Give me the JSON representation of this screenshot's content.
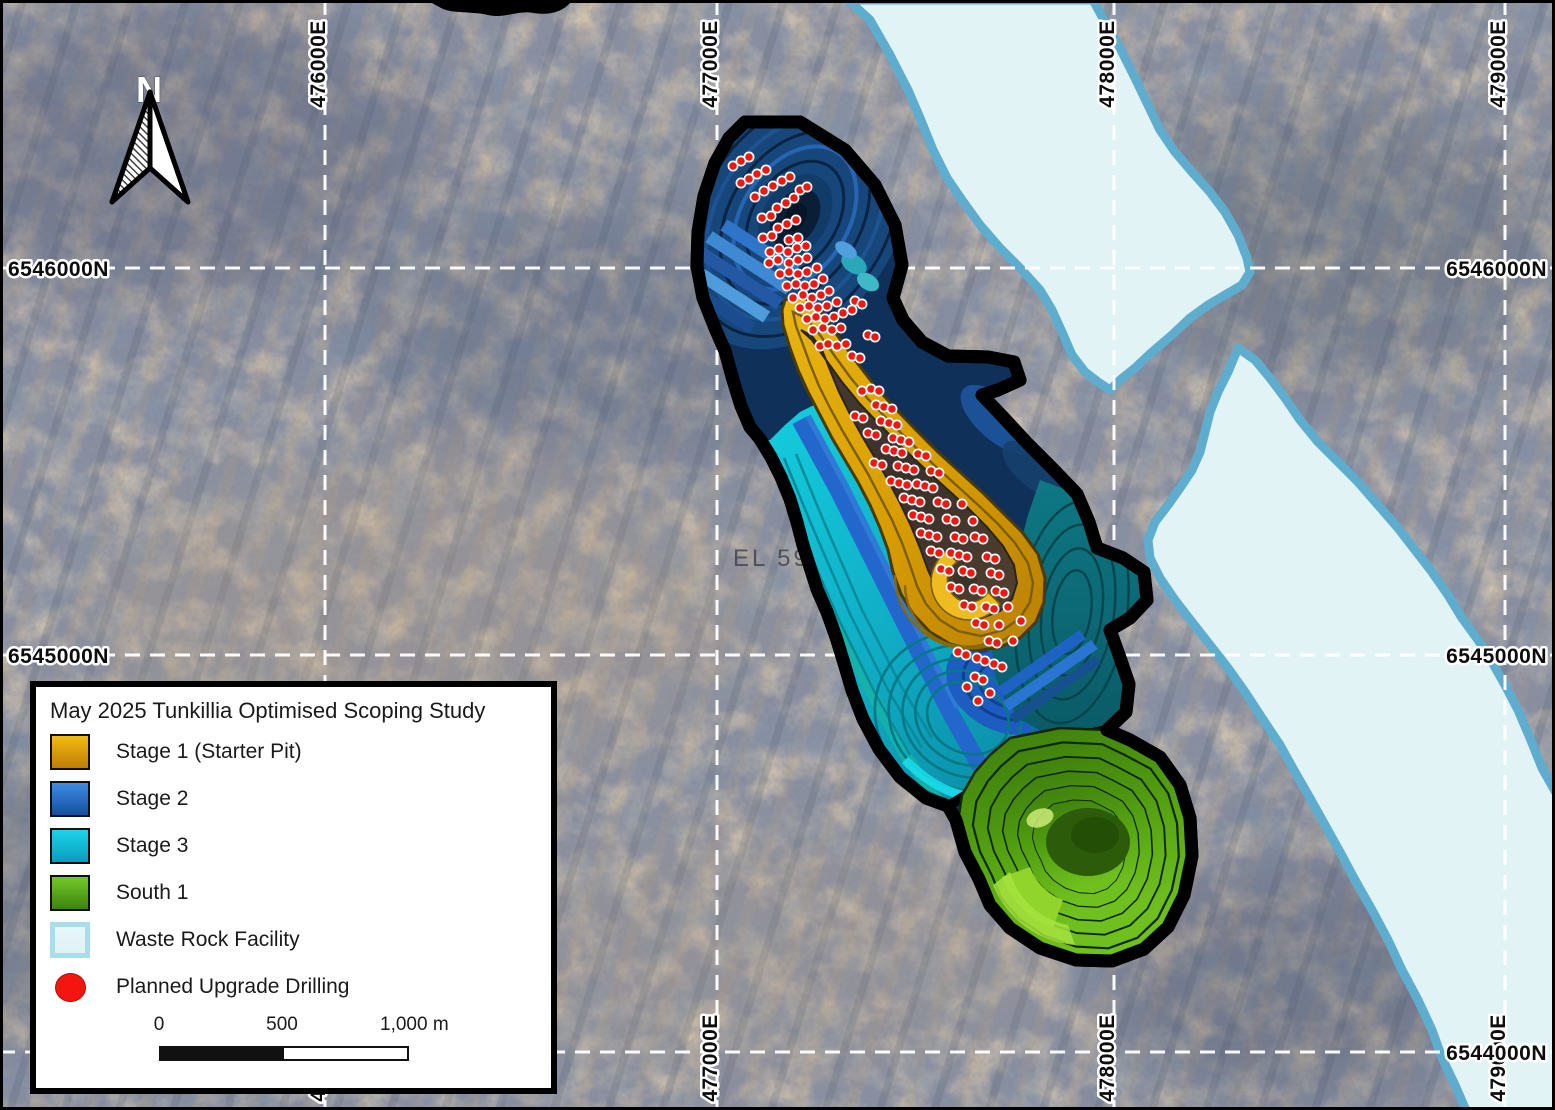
{
  "map": {
    "compass_label": "N",
    "tenement_label": "EL 590",
    "grid": {
      "eastings": [
        {
          "label": "476000E",
          "x": 325
        },
        {
          "label": "477000E",
          "x": 717
        },
        {
          "label": "478000E",
          "x": 1114
        },
        {
          "label": "479000E",
          "x": 1505
        }
      ],
      "northings": [
        {
          "label": "6546000N",
          "y": 268,
          "sides": [
            "left",
            "right"
          ]
        },
        {
          "label": "6545000N",
          "y": 655,
          "sides": [
            "left",
            "right"
          ]
        },
        {
          "label": "6544000N",
          "y": 1052,
          "sides": [
            "right"
          ]
        }
      ]
    },
    "colors": {
      "grid_line": "#ffffff",
      "pit_outline": "#000000",
      "stage1_gold": "#e0a706",
      "stage2_blue": "#1f62c4",
      "stage3_cyan": "#12c2d8",
      "south1_green": "#55a312",
      "wrf_fill": "#e2f3f5",
      "wrf_border": "#5fadce",
      "drill_red": "#ee1812"
    },
    "drill_points": [
      [
        733,
        166
      ],
      [
        741,
        161
      ],
      [
        749,
        157
      ],
      [
        741,
        183
      ],
      [
        749,
        179
      ],
      [
        757,
        174
      ],
      [
        766,
        170
      ],
      [
        755,
        197
      ],
      [
        764,
        191
      ],
      [
        773,
        186
      ],
      [
        782,
        181
      ],
      [
        790,
        177
      ],
      [
        777,
        208
      ],
      [
        786,
        203
      ],
      [
        794,
        198
      ],
      [
        762,
        218
      ],
      [
        771,
        216
      ],
      [
        800,
        190
      ],
      [
        807,
        187
      ],
      [
        778,
        228
      ],
      [
        787,
        224
      ],
      [
        796,
        220
      ],
      [
        763,
        238
      ],
      [
        772,
        236
      ],
      [
        789,
        240
      ],
      [
        798,
        238
      ],
      [
        770,
        252
      ],
      [
        779,
        249
      ],
      [
        788,
        252
      ],
      [
        797,
        248
      ],
      [
        806,
        246
      ],
      [
        769,
        263
      ],
      [
        778,
        260
      ],
      [
        789,
        263
      ],
      [
        798,
        260
      ],
      [
        807,
        258
      ],
      [
        780,
        274
      ],
      [
        789,
        272
      ],
      [
        798,
        274
      ],
      [
        807,
        272
      ],
      [
        817,
        268
      ],
      [
        787,
        286
      ],
      [
        796,
        284
      ],
      [
        805,
        286
      ],
      [
        814,
        284
      ],
      [
        823,
        279
      ],
      [
        793,
        298
      ],
      [
        803,
        295
      ],
      [
        812,
        298
      ],
      [
        821,
        295
      ],
      [
        829,
        291
      ],
      [
        800,
        308
      ],
      [
        809,
        306
      ],
      [
        818,
        308
      ],
      [
        827,
        306
      ],
      [
        837,
        302
      ],
      [
        852,
        310
      ],
      [
        807,
        319
      ],
      [
        816,
        317
      ],
      [
        825,
        319
      ],
      [
        834,
        317
      ],
      [
        843,
        313
      ],
      [
        813,
        330
      ],
      [
        823,
        328
      ],
      [
        832,
        330
      ],
      [
        841,
        328
      ],
      [
        855,
        301
      ],
      [
        862,
        304
      ],
      [
        868,
        335
      ],
      [
        875,
        337
      ],
      [
        820,
        346
      ],
      [
        828,
        344
      ],
      [
        837,
        346
      ],
      [
        846,
        344
      ],
      [
        852,
        356
      ],
      [
        860,
        358
      ],
      [
        862,
        391
      ],
      [
        871,
        389
      ],
      [
        879,
        391
      ],
      [
        876,
        405
      ],
      [
        884,
        407
      ],
      [
        892,
        409
      ],
      [
        855,
        416
      ],
      [
        863,
        418
      ],
      [
        881,
        421
      ],
      [
        889,
        423
      ],
      [
        897,
        425
      ],
      [
        868,
        433
      ],
      [
        876,
        435
      ],
      [
        893,
        438
      ],
      [
        901,
        440
      ],
      [
        909,
        442
      ],
      [
        886,
        449
      ],
      [
        894,
        451
      ],
      [
        902,
        453
      ],
      [
        918,
        454
      ],
      [
        926,
        456
      ],
      [
        874,
        463
      ],
      [
        882,
        465
      ],
      [
        898,
        466
      ],
      [
        906,
        468
      ],
      [
        914,
        470
      ],
      [
        931,
        471
      ],
      [
        939,
        473
      ],
      [
        891,
        481
      ],
      [
        899,
        483
      ],
      [
        907,
        485
      ],
      [
        917,
        484
      ],
      [
        925,
        486
      ],
      [
        933,
        488
      ],
      [
        904,
        498
      ],
      [
        912,
        500
      ],
      [
        920,
        502
      ],
      [
        938,
        502
      ],
      [
        946,
        504
      ],
      [
        962,
        504
      ],
      [
        913,
        515
      ],
      [
        921,
        517
      ],
      [
        929,
        519
      ],
      [
        947,
        519
      ],
      [
        955,
        521
      ],
      [
        973,
        521
      ],
      [
        921,
        533
      ],
      [
        929,
        535
      ],
      [
        937,
        537
      ],
      [
        955,
        537
      ],
      [
        963,
        539
      ],
      [
        975,
        537
      ],
      [
        983,
        539
      ],
      [
        931,
        551
      ],
      [
        939,
        553
      ],
      [
        951,
        553
      ],
      [
        959,
        555
      ],
      [
        967,
        557
      ],
      [
        987,
        557
      ],
      [
        995,
        559
      ],
      [
        941,
        569
      ],
      [
        949,
        571
      ],
      [
        963,
        571
      ],
      [
        971,
        573
      ],
      [
        991,
        573
      ],
      [
        999,
        575
      ],
      [
        951,
        587
      ],
      [
        959,
        589
      ],
      [
        974,
        589
      ],
      [
        982,
        591
      ],
      [
        996,
        591
      ],
      [
        1004,
        593
      ],
      [
        964,
        605
      ],
      [
        972,
        607
      ],
      [
        986,
        607
      ],
      [
        994,
        609
      ],
      [
        1008,
        607
      ],
      [
        976,
        623
      ],
      [
        984,
        625
      ],
      [
        999,
        625
      ],
      [
        1021,
        621
      ],
      [
        989,
        641
      ],
      [
        997,
        643
      ],
      [
        1013,
        641
      ],
      [
        958,
        652
      ],
      [
        966,
        655
      ],
      [
        977,
        658
      ],
      [
        985,
        661
      ],
      [
        994,
        664
      ],
      [
        1002,
        667
      ],
      [
        975,
        677
      ],
      [
        983,
        680
      ],
      [
        967,
        687
      ],
      [
        990,
        693
      ],
      [
        978,
        701
      ]
    ]
  },
  "legend": {
    "title": "May 2025 Tunkillia Optimised Scoping Study",
    "items": [
      {
        "id": "stage-1",
        "label": "Stage 1 (Starter Pit)",
        "type": "square",
        "c1": "#f2bc12",
        "c2": "#c07c06"
      },
      {
        "id": "stage-2",
        "label": "Stage 2",
        "type": "square",
        "c1": "#3f8ce4",
        "c2": "#144f9e"
      },
      {
        "id": "stage-3",
        "label": "Stage 3",
        "type": "square",
        "c1": "#1cd4ea",
        "c2": "#0b9cba"
      },
      {
        "id": "south-1",
        "label": "South 1",
        "type": "square",
        "c1": "#74c828",
        "c2": "#3c8410"
      },
      {
        "id": "waste-rock-facility",
        "label": "Waste Rock Facility",
        "type": "square-thick",
        "c1": "#e8f6f8",
        "c2": "#e0f2f5"
      },
      {
        "id": "planned-upgrade-drilling",
        "label": "Planned Upgrade Drilling",
        "type": "circle",
        "c1": "#f41510",
        "c2": "#d80d08"
      }
    ],
    "scalebar": {
      "start": "0",
      "mid": "500",
      "end": "1,000 m"
    }
  }
}
